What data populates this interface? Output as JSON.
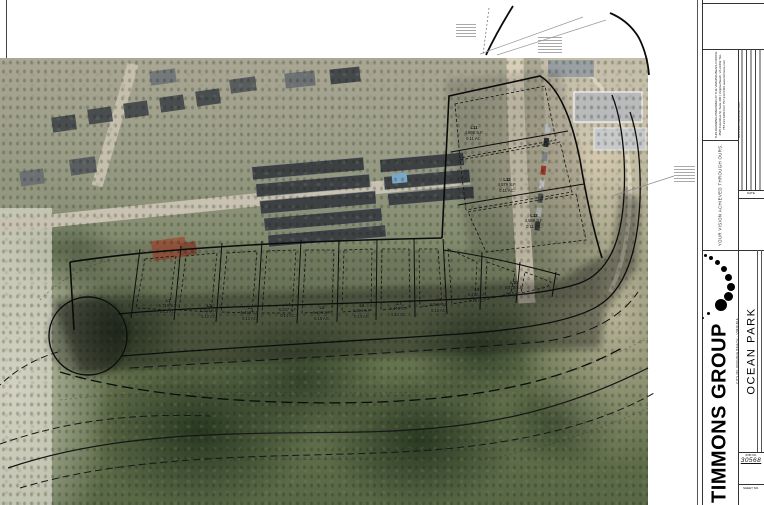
{
  "title_block": {
    "prepared_note_lines": "THIS DRAWING PREPARED AT THE VIRGINIA BEACH OFFICE 4525 Columbus St, Suite 400 | Virginia Beach, VA 23462 TEL 757.213.6400 FAX 757.213.6401 www.timmons.com",
    "tagline": "YOUR VISION ACHIEVED THROUGH OURS.",
    "revision_header": "REVISION DESCRIPTION",
    "date_label": "DATE",
    "fields": [
      {
        "label": "DESIGNED BY",
        "value": "T. SOUTHWORTH"
      },
      {
        "label": "DRAWN BY",
        "value": "T. SOUTHWORTH"
      },
      {
        "label": "CHECKED BY",
        "value": "C. ARRA"
      },
      {
        "label": "SCALE",
        "value": ""
      }
    ],
    "company": "TIMMONS GROUP",
    "project": "OCEAN PARK",
    "location": "CITY OF VIRGINIA BEACH - VIRGINIA",
    "job_no_label": "JOB NO.",
    "job_no": "30568",
    "sheet_no_label": "SHEET NO."
  },
  "plan": {
    "lots": [
      {
        "id": "L1",
        "sf": "5,719 S.F.",
        "ac": "0.13 AC.",
        "x": 168,
        "y": 306
      },
      {
        "id": "L2",
        "sf": "5,084 S.F.",
        "ac": "0.12 AC.",
        "x": 209,
        "y": 311
      },
      {
        "id": "L3",
        "sf": "5,449 S.F.",
        "ac": "0.12 AC.",
        "x": 250,
        "y": 313
      },
      {
        "id": "L4",
        "sf": "6,037 S.F.",
        "ac": "0.14 AC.",
        "x": 288,
        "y": 310
      },
      {
        "id": "L5",
        "sf": "6,446 S.F.",
        "ac": "0.15 AC.",
        "x": 322,
        "y": 313
      },
      {
        "id": "L6",
        "sf": "6,294 S.F.",
        "ac": "0.14 AC.",
        "x": 362,
        "y": 311
      },
      {
        "id": "L7",
        "sf": "6,472 S.F.",
        "ac": "0.14 AC.",
        "x": 399,
        "y": 309
      },
      {
        "id": "L8",
        "sf": "6,585 S.F.",
        "ac": "0.15 AC.",
        "x": 439,
        "y": 305
      },
      {
        "id": "L9",
        "sf": "6,442 S.F.",
        "ac": "0.15 AC.",
        "x": 477,
        "y": 295
      },
      {
        "id": "L10",
        "sf": "6,473 S.F.",
        "ac": "0.15 AC.",
        "x": 514,
        "y": 288
      },
      {
        "id": "L11",
        "sf": "4,896 S.F.",
        "ac": "0.11 AC.",
        "x": 474,
        "y": 133
      },
      {
        "id": "L12",
        "sf": "4,579 S.F.",
        "ac": "0.11 AC.",
        "x": 507,
        "y": 185
      },
      {
        "id": "L13",
        "sf": "4,588 S.F.",
        "ac": "0.11 AC.",
        "x": 534,
        "y": 221
      }
    ]
  }
}
